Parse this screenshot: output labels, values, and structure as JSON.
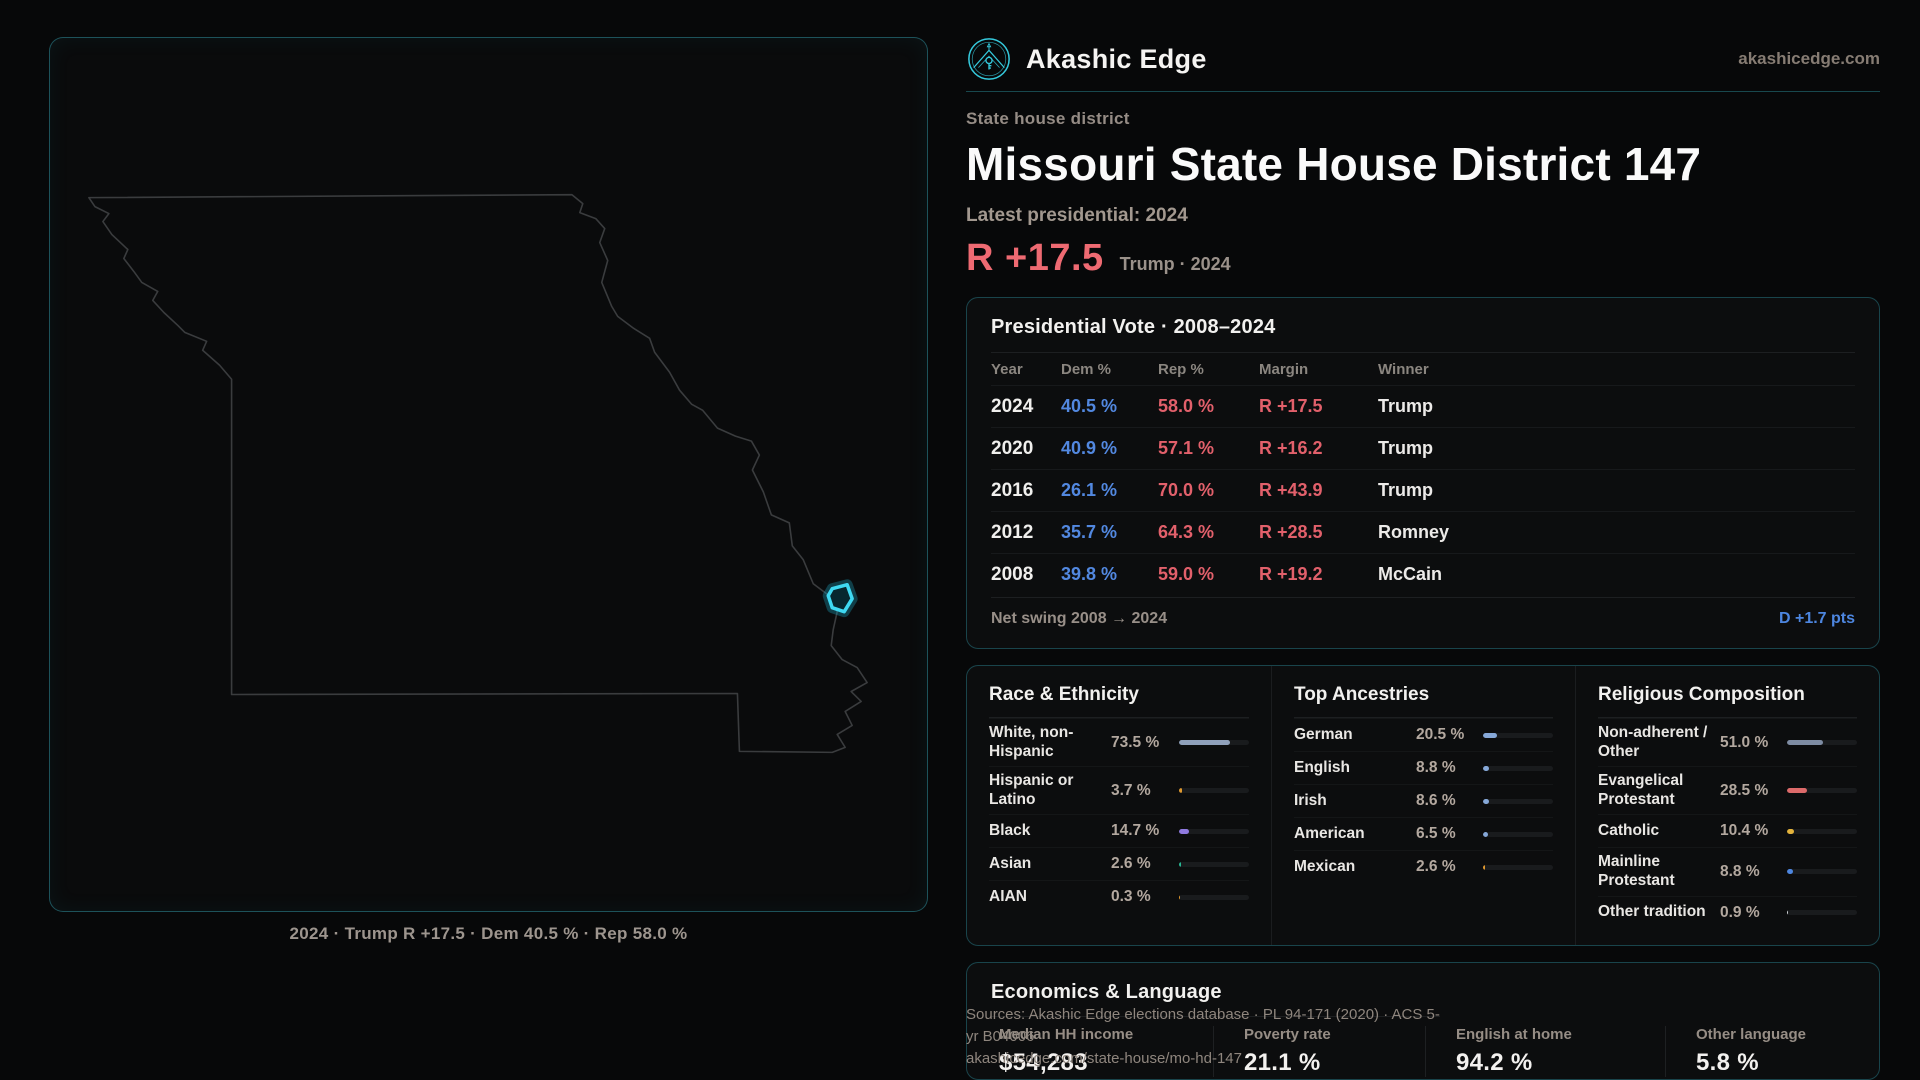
{
  "brand": {
    "name": "Akashic Edge",
    "domain": "akashicedge.com",
    "accent_color": "#35c9dc"
  },
  "header": {
    "kicker": "State house district",
    "title": "Missouri State House District 147",
    "subtitle": "Latest presidential: 2024",
    "margin_value": "R +17.5",
    "margin_context": "Trump · 2024",
    "margin_color": "#ee6a72"
  },
  "map": {
    "state": "Missouri",
    "caption": "2024 · Trump R +17.5 · Dem 40.5 % · Rep 58.0 %",
    "district_highlight_color": "#3fd9f2"
  },
  "presidential_table": {
    "title": "Presidential Vote · 2008–2024",
    "columns": {
      "year": "Year",
      "dem": "Dem %",
      "rep": "Rep %",
      "margin": "Margin",
      "winner": "Winner"
    },
    "rows": [
      {
        "year": "2024",
        "dem": "40.5 %",
        "rep": "58.0 %",
        "margin": "R +17.5",
        "winner": "Trump"
      },
      {
        "year": "2020",
        "dem": "40.9 %",
        "rep": "57.1 %",
        "margin": "R +16.2",
        "winner": "Trump"
      },
      {
        "year": "2016",
        "dem": "26.1 %",
        "rep": "70.0 %",
        "margin": "R +43.9",
        "winner": "Trump"
      },
      {
        "year": "2012",
        "dem": "35.7 %",
        "rep": "64.3 %",
        "margin": "R +28.5",
        "winner": "Romney"
      },
      {
        "year": "2008",
        "dem": "39.8 %",
        "rep": "59.0 %",
        "margin": "R +19.2",
        "winner": "McCain"
      }
    ],
    "footer_label": "Net swing 2008 → 2024",
    "footer_value": "D +1.7 pts",
    "dem_color": "#5288e0",
    "rep_color": "#e2606b"
  },
  "demographics": {
    "race": {
      "title": "Race & Ethnicity",
      "rows": [
        {
          "label": "White, non-Hispanic",
          "value": "73.5 %",
          "pct": 73.5,
          "color": "#8fa0ba"
        },
        {
          "label": "Hispanic or Latino",
          "value": "3.7 %",
          "pct": 3.7,
          "color": "#e0992f"
        },
        {
          "label": "Black",
          "value": "14.7 %",
          "pct": 14.7,
          "color": "#8f7ae0"
        },
        {
          "label": "Asian",
          "value": "2.6 %",
          "pct": 2.6,
          "color": "#27b793"
        },
        {
          "label": "AIAN",
          "value": "0.3 %",
          "pct": 0.3,
          "color": "#e0992f"
        }
      ]
    },
    "ancestries": {
      "title": "Top Ancestries",
      "rows": [
        {
          "label": "German",
          "value": "20.5 %",
          "pct": 20.5,
          "color": "#86a8d8"
        },
        {
          "label": "English",
          "value": "8.8 %",
          "pct": 8.8,
          "color": "#86a8d8"
        },
        {
          "label": "Irish",
          "value": "8.6 %",
          "pct": 8.6,
          "color": "#86a8d8"
        },
        {
          "label": "American",
          "value": "6.5 %",
          "pct": 6.5,
          "color": "#86a8d8"
        },
        {
          "label": "Mexican",
          "value": "2.6 %",
          "pct": 2.6,
          "color": "#e0992f"
        }
      ]
    },
    "religion": {
      "title": "Religious Composition",
      "rows": [
        {
          "label": "Non-adherent / Other",
          "value": "51.0 %",
          "pct": 51.0,
          "color": "#7e8ca3"
        },
        {
          "label": "Evangelical Protestant",
          "value": "28.5 %",
          "pct": 28.5,
          "color": "#dd6a6a"
        },
        {
          "label": "Catholic",
          "value": "10.4 %",
          "pct": 10.4,
          "color": "#e3b33c"
        },
        {
          "label": "Mainline Protestant",
          "value": "8.8 %",
          "pct": 8.8,
          "color": "#4d86e0"
        },
        {
          "label": "Other tradition",
          "value": "0.9 %",
          "pct": 0.9,
          "color": "#cfd2d6"
        }
      ]
    }
  },
  "economics": {
    "title": "Economics & Language",
    "stats": [
      {
        "label": "Median HH income",
        "value": "$54,283"
      },
      {
        "label": "Poverty rate",
        "value": "21.1 %"
      },
      {
        "label": "English at home",
        "value": "94.2 %"
      },
      {
        "label": "Other language",
        "value": "5.8 %"
      }
    ]
  },
  "sources": {
    "line1": "Sources: Akashic Edge elections database · PL 94-171 (2020) · ACS 5-yr B04006",
    "line2": "akashicedge.com/state-house/mo-hd-147"
  }
}
